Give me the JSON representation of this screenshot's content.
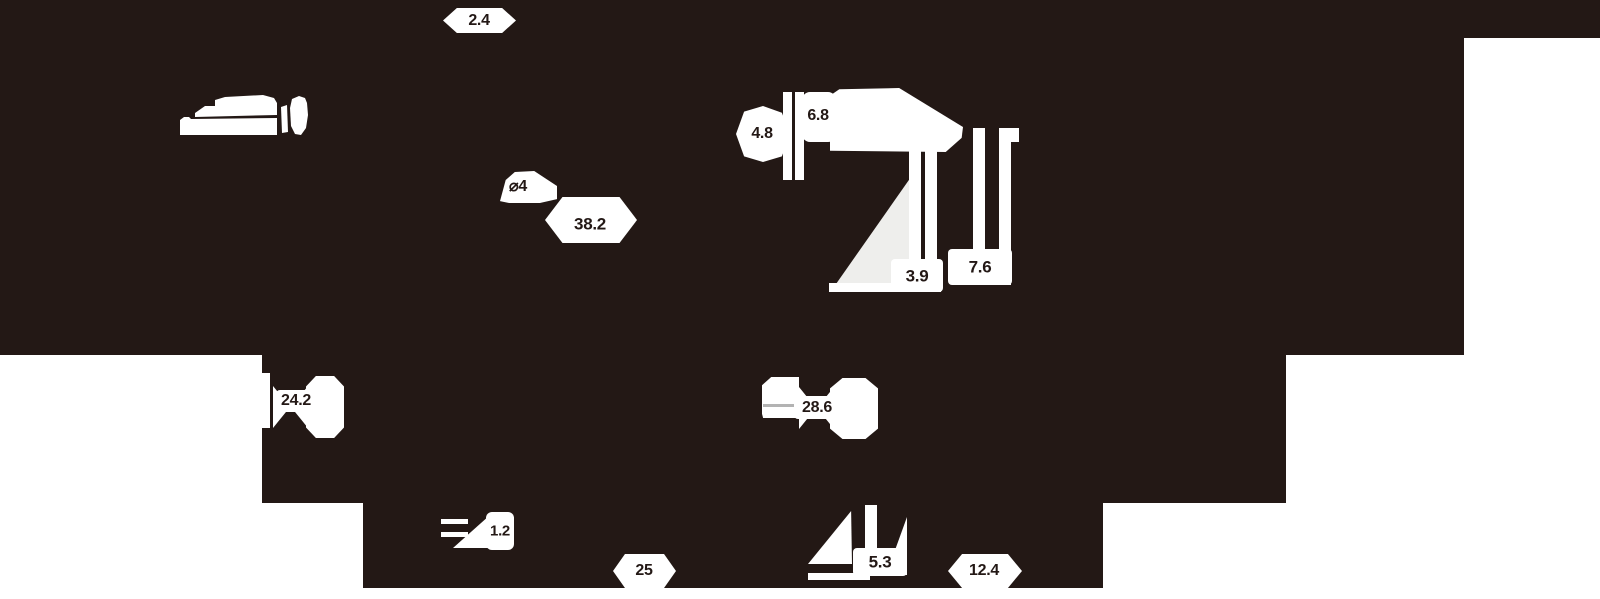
{
  "canvas": {
    "width": 1600,
    "height": 599
  },
  "colors": {
    "background": "#231815",
    "shape_fill": "#ffffff",
    "panel_fill": "#ffffff",
    "triangle_fill": "#eeeeec",
    "accent_line": "#b3b3b3",
    "dimension_text": "#231815"
  },
  "dims": {
    "d2_4": {
      "value": "2.4"
    },
    "d_phi4": {
      "value": "⌀4"
    },
    "d38_2": {
      "value": "38.2"
    },
    "d4_8": {
      "value": "4.8"
    },
    "d6_8": {
      "value": "6.8"
    },
    "d3_9": {
      "value": "3.9"
    },
    "d7_6": {
      "value": "7.6"
    },
    "d24_2": {
      "value": "24.2"
    },
    "d28_6": {
      "value": "28.6"
    },
    "d1_2": {
      "value": "1.2"
    },
    "d25": {
      "value": "25"
    },
    "d5_3": {
      "value": "5.3"
    },
    "d12_4": {
      "value": "12.4"
    }
  }
}
